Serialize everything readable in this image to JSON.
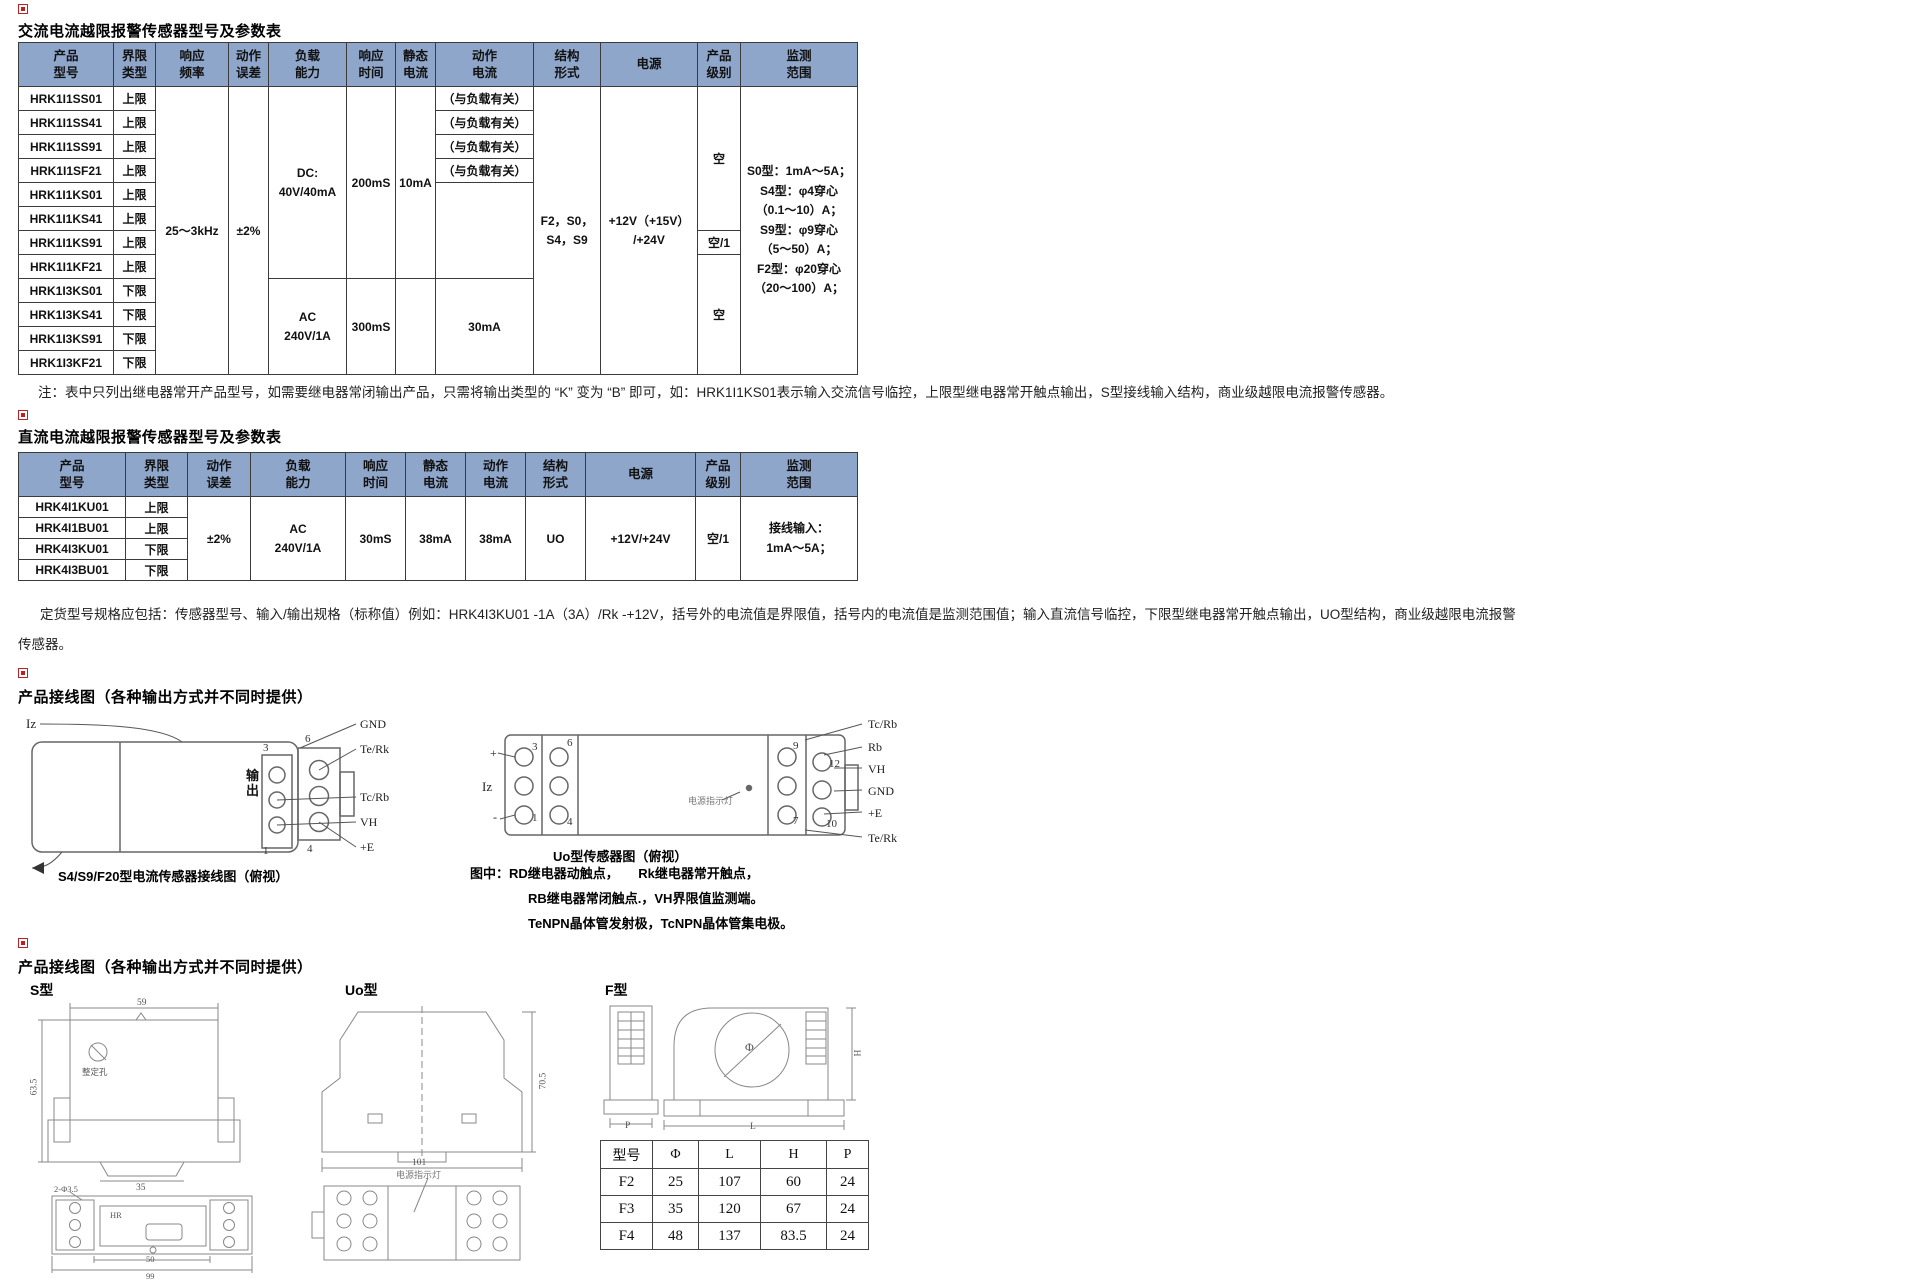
{
  "colors": {
    "header_bg": "#8FA6CB",
    "table_border": "#3b3b3b",
    "marker_red": "#bb2222",
    "background": "#ffffff"
  },
  "sections": {
    "ac": {
      "title": "交流电流越限报警传感器型号及参数表",
      "note": "注：表中只列出继电器常开产品型号，如需要继电器常闭输出产品，只需将输出类型的 “K” 变为 “B” 即可，如：HRK1I1KS01表示输入交流信号临控，上限型继电器常开触点输出，S型接线输入结构，商业级越限电流报警传感器。",
      "table": {
        "headers": [
          "产品型号",
          "界限类型",
          "响应频率",
          "动作误差",
          "负载能力",
          "响应时间",
          "静态电流",
          "动作电流",
          "结构形式",
          "电源",
          "产品级别",
          "监测范围"
        ],
        "rows": [
          {
            "model": "HRK1I1SS01",
            "limit": "上限"
          },
          {
            "model": "HRK1I1SS41",
            "limit": "上限"
          },
          {
            "model": "HRK1I1SS91",
            "limit": "上限"
          },
          {
            "model": "HRK1I1SF21",
            "limit": "上限"
          },
          {
            "model": "HRK1I1KS01",
            "limit": "上限"
          },
          {
            "model": "HRK1I1KS41",
            "limit": "上限"
          },
          {
            "model": "HRK1I1KS91",
            "limit": "上限"
          },
          {
            "model": "HRK1I1KF21",
            "limit": "上限"
          },
          {
            "model": "HRK1I3KS01",
            "limit": "下限"
          },
          {
            "model": "HRK1I3KS41",
            "limit": "下限"
          },
          {
            "model": "HRK1I3KS91",
            "limit": "下限"
          },
          {
            "model": "HRK1I3KF21",
            "limit": "下限"
          }
        ],
        "freq": "25～3kHz",
        "error": "±2%",
        "load_dc": [
          "DC:",
          "40V/40mA"
        ],
        "load_ac": [
          "AC",
          "240V/1A"
        ],
        "resp_dc": "200mS",
        "resp_ac": "300mS",
        "static_dc": "10mA",
        "action_load": "（与负载有关）",
        "action_ac": "30mA",
        "structure": [
          "F2，S0，",
          "S4，S9"
        ],
        "power": [
          "+12V（+15V）",
          "/+24V"
        ],
        "grade_top": "空",
        "grade_mid": "空/1",
        "grade_bottom": "空",
        "monitor": [
          "S0型：1mA～5A；",
          "S4型：φ4穿心",
          "（0.1～10）A；",
          "S9型：φ9穿心",
          "（5～50）A；",
          "F2型：φ20穿心",
          "（20～100）A；"
        ]
      }
    },
    "dc": {
      "title": "直流电流越限报警传感器型号及参数表",
      "note_line1": "定货型号规格应包括：传感器型号、输入/输出规格（标称值）例如：HRK4I3KU01 -1A（3A）/Rk -+12V，括号外的电流值是界限值，括号内的电流值是监测范围值；输入直流信号临控，下限型继电器常开触点输出，UO型结构，商业级越限电流报警",
      "note_line2": "传感器。",
      "table": {
        "headers": [
          "产品型号",
          "界限类型",
          "动作误差",
          "负载能力",
          "响应时间",
          "静态电流",
          "动作电流",
          "结构形式",
          "电源",
          "产品级别",
          "监测范围"
        ],
        "rows": [
          {
            "model": "HRK4I1KU01",
            "limit": "上限"
          },
          {
            "model": "HRK4I1BU01",
            "limit": "上限"
          },
          {
            "model": "HRK4I3KU01",
            "limit": "下限"
          },
          {
            "model": "HRK4I3BU01",
            "limit": "下限"
          }
        ],
        "error": "±2%",
        "load": [
          "AC",
          "240V/1A"
        ],
        "resp": "30mS",
        "static": "38mA",
        "action": "38mA",
        "structure": "UO",
        "power": "+12V/+24V",
        "grade": "空/1",
        "monitor": [
          "接线输入：",
          "1mA～5A；"
        ]
      }
    },
    "wiring1": {
      "title": "产品接线图（各种输出方式并不同时提供）",
      "left": {
        "iz": "Iz",
        "output": "输出",
        "caption": "S4/S9/F20型电流传感器接线图（俯视）",
        "num3": "3",
        "num6": "6",
        "num1": "1",
        "num4": "4",
        "labels": [
          "GND",
          "Te/Rk",
          "Tc/Rb",
          "VH",
          "+E"
        ]
      },
      "right": {
        "plus": "+",
        "iz": "Iz",
        "minus": "-",
        "caption": "Uo型传感器图（俯视）",
        "power_led": "电源指示灯",
        "num3": "3",
        "num6": "6",
        "num1": "1",
        "num4": "4",
        "num9": "9",
        "num12": "12",
        "num7": "7",
        "num10": "10",
        "labels": [
          "Tc/Rb",
          "Rb",
          "VH",
          "GND",
          "+E",
          "Te/Rk"
        ]
      },
      "legend": [
        "图中：RD继电器动触点，　　Rk继电器常开触点，",
        "RB继电器常闭触点.，VH界限值监测端。",
        "TeNPN晶体管发射极，TcNPN晶体管集电极。"
      ]
    },
    "wiring2": {
      "title": "产品接线图（各种输出方式并不同时提供）",
      "s_label": "S型",
      "uo_label": "Uo型",
      "f_label": "F型",
      "s_dims": {
        "w": "59",
        "h": "63.5",
        "clip": "35",
        "holes": "2-Φ3.5",
        "inner": "HR",
        "pot": "整定孔",
        "d50": "50",
        "d99": "99"
      },
      "uo_dims": {
        "h": "70.5",
        "w": "101",
        "led": "电源指示灯"
      },
      "f_dims": {
        "p": "P",
        "l": "L",
        "h": "H",
        "phi": "Φ"
      },
      "dim_table": {
        "headers": [
          "型号",
          "Φ",
          "L",
          "H",
          "P"
        ],
        "rows": [
          [
            "F2",
            "25",
            "107",
            "60",
            "24"
          ],
          [
            "F3",
            "35",
            "120",
            "67",
            "24"
          ],
          [
            "F4",
            "48",
            "137",
            "83.5",
            "24"
          ]
        ]
      }
    }
  }
}
